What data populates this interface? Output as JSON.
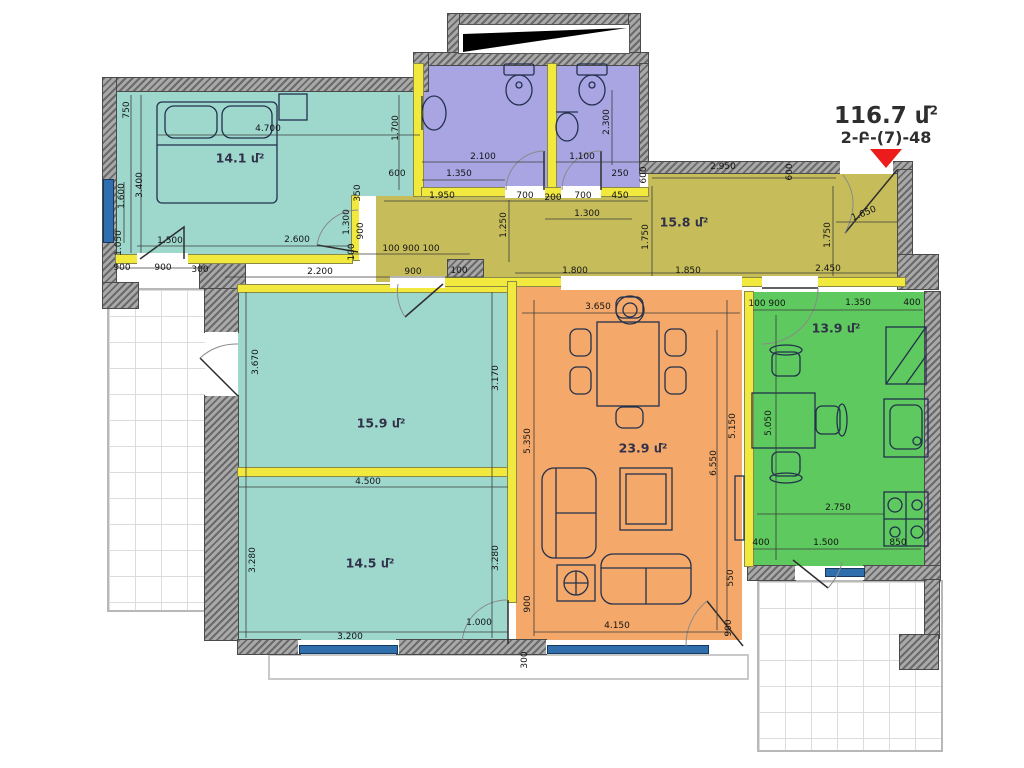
{
  "title": {
    "area": "116.7 մ",
    "sup": "2",
    "code": "2-Բ-(7)-48"
  },
  "rooms": [
    {
      "id": "bedroom",
      "area_label": "14.1 մ²",
      "color": "#9ed8cd"
    },
    {
      "id": "hall",
      "area_label": "15.8 մ²",
      "color": "#c6bd5a"
    },
    {
      "id": "living",
      "area_label": "15.9 մ²",
      "color": "#9ed8cd"
    },
    {
      "id": "bedroom2",
      "area_label": "14.5 մ²",
      "color": "#9ed8cd"
    },
    {
      "id": "dining",
      "area_label": "23.9 մ²",
      "color": "#f4a869"
    },
    {
      "id": "kitchen",
      "area_label": "13.9 մ²",
      "color": "#5ec95e"
    },
    {
      "id": "bathroom1",
      "color": "#a9a5e3"
    },
    {
      "id": "bathroom2",
      "color": "#a9a5e3"
    }
  ],
  "accent_colors": {
    "window": "#2f6fae",
    "partition_wall": "#f2e93e",
    "entrance_arrow": "#ec1c1c"
  },
  "dimensions": [
    {
      "t": "750",
      "x": 127,
      "y": 110,
      "r": -90
    },
    {
      "t": "4.700",
      "x": 268,
      "y": 129
    },
    {
      "t": "1.600",
      "x": 122,
      "y": 196,
      "r": -90
    },
    {
      "t": "3.400",
      "x": 140,
      "y": 185,
      "r": -90
    },
    {
      "t": "1.700",
      "x": 396,
      "y": 128,
      "r": -90
    },
    {
      "t": "600",
      "x": 397,
      "y": 174
    },
    {
      "t": "350",
      "x": 358,
      "y": 193,
      "r": -90
    },
    {
      "t": "1.300",
      "x": 347,
      "y": 222,
      "r": -90
    },
    {
      "t": "900",
      "x": 361,
      "y": 231,
      "r": -90
    },
    {
      "t": "100",
      "x": 352,
      "y": 252,
      "r": -90
    },
    {
      "t": "1.500",
      "x": 170,
      "y": 241
    },
    {
      "t": "2.600",
      "x": 297,
      "y": 240
    },
    {
      "t": "1.050",
      "x": 119,
      "y": 243,
      "r": -90
    },
    {
      "t": "900",
      "x": 122,
      "y": 268
    },
    {
      "t": "900",
      "x": 163,
      "y": 268
    },
    {
      "t": "300",
      "x": 200,
      "y": 270
    },
    {
      "t": "2.200",
      "x": 320,
      "y": 272
    },
    {
      "t": "900",
      "x": 413,
      "y": 272
    },
    {
      "t": "100",
      "x": 459,
      "y": 271
    },
    {
      "t": "100 900 100",
      "x": 411,
      "y": 249
    },
    {
      "t": "2.100",
      "x": 483,
      "y": 157
    },
    {
      "t": "1.350",
      "x": 459,
      "y": 174
    },
    {
      "t": "1.100",
      "x": 582,
      "y": 157
    },
    {
      "t": "2.300",
      "x": 607,
      "y": 122,
      "r": -90
    },
    {
      "t": "250",
      "x": 620,
      "y": 174
    },
    {
      "t": "1.950",
      "x": 442,
      "y": 196
    },
    {
      "t": "700",
      "x": 525,
      "y": 196
    },
    {
      "t": "200",
      "x": 553,
      "y": 198
    },
    {
      "t": "700",
      "x": 583,
      "y": 196
    },
    {
      "t": "450",
      "x": 620,
      "y": 196
    },
    {
      "t": "1.300",
      "x": 587,
      "y": 214
    },
    {
      "t": "1.250",
      "x": 504,
      "y": 225,
      "r": -90
    },
    {
      "t": "600",
      "x": 644,
      "y": 175,
      "r": -90
    },
    {
      "t": "2.950",
      "x": 723,
      "y": 167
    },
    {
      "t": "600",
      "x": 790,
      "y": 172,
      "r": -90
    },
    {
      "t": "1.750",
      "x": 646,
      "y": 237,
      "r": -90
    },
    {
      "t": "1.750",
      "x": 828,
      "y": 235,
      "r": -90
    },
    {
      "t": "1.650",
      "x": 864,
      "y": 214,
      "r": -22
    },
    {
      "t": "1.800",
      "x": 575,
      "y": 271
    },
    {
      "t": "1.850",
      "x": 688,
      "y": 271
    },
    {
      "t": "2.450",
      "x": 828,
      "y": 269
    },
    {
      "t": "3.670",
      "x": 256,
      "y": 362,
      "r": -90
    },
    {
      "t": "3.170",
      "x": 496,
      "y": 378,
      "r": -90
    },
    {
      "t": "4.500",
      "x": 368,
      "y": 482
    },
    {
      "t": "3.280",
      "x": 253,
      "y": 560,
      "r": -90
    },
    {
      "t": "3.280",
      "x": 496,
      "y": 558,
      "r": -90
    },
    {
      "t": "3.200",
      "x": 350,
      "y": 637
    },
    {
      "t": "1.000",
      "x": 479,
      "y": 623
    },
    {
      "t": "300",
      "x": 525,
      "y": 660,
      "r": -90
    },
    {
      "t": "3.650",
      "x": 598,
      "y": 307
    },
    {
      "t": "5.350",
      "x": 528,
      "y": 441,
      "r": -90
    },
    {
      "t": "5.150",
      "x": 733,
      "y": 426,
      "r": -90
    },
    {
      "t": "6.550",
      "x": 714,
      "y": 463,
      "r": -90
    },
    {
      "t": "550",
      "x": 731,
      "y": 578,
      "r": -90
    },
    {
      "t": "900",
      "x": 528,
      "y": 604,
      "r": -90
    },
    {
      "t": "4.150",
      "x": 617,
      "y": 626
    },
    {
      "t": "900",
      "x": 729,
      "y": 628,
      "r": -90
    },
    {
      "t": "100",
      "x": 757,
      "y": 304
    },
    {
      "t": "900",
      "x": 777,
      "y": 304
    },
    {
      "t": "1.350",
      "x": 858,
      "y": 303
    },
    {
      "t": "400",
      "x": 912,
      "y": 303
    },
    {
      "t": "5.050",
      "x": 769,
      "y": 423,
      "r": -90
    },
    {
      "t": "2.750",
      "x": 838,
      "y": 508
    },
    {
      "t": "400",
      "x": 761,
      "y": 543
    },
    {
      "t": "1.500",
      "x": 826,
      "y": 543
    },
    {
      "t": "850",
      "x": 898,
      "y": 543
    },
    {
      "t": "14.1 մ²",
      "x": 240,
      "y": 158,
      "cls": "room"
    },
    {
      "t": "15.8 մ²",
      "x": 684,
      "y": 222,
      "cls": "room"
    },
    {
      "t": "15.9 մ²",
      "x": 381,
      "y": 423,
      "cls": "room"
    },
    {
      "t": "14.5 մ²",
      "x": 370,
      "y": 563,
      "cls": "room"
    },
    {
      "t": "23.9 մ²",
      "x": 643,
      "y": 448,
      "cls": "room"
    },
    {
      "t": "13.9 մ²",
      "x": 836,
      "y": 328,
      "cls": "room"
    }
  ]
}
